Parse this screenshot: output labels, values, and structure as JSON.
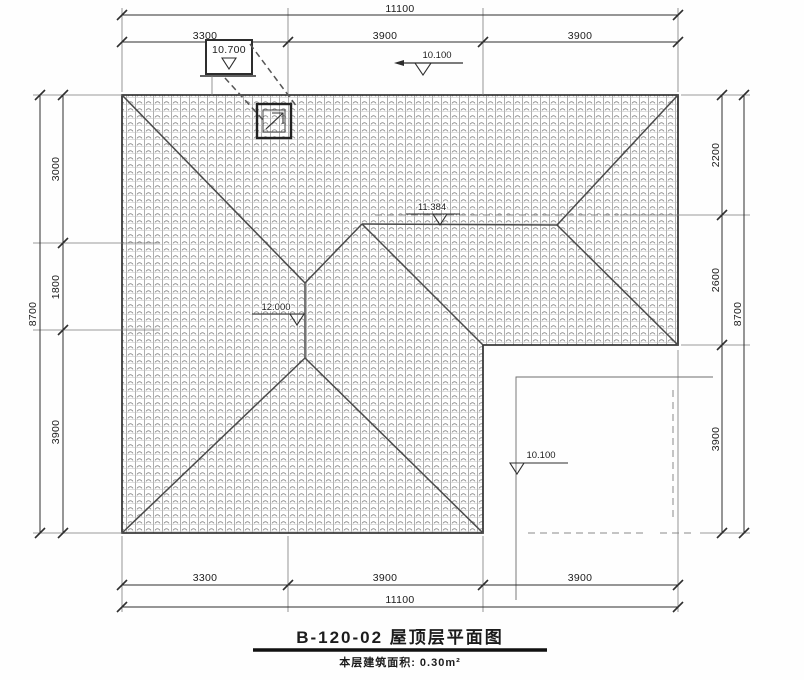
{
  "drawing": {
    "title": "B-120-02 屋顶层平面图",
    "area_note": "本层建筑面积: 0.30m²"
  },
  "dimensions": {
    "top": {
      "overall": "11100",
      "segments": [
        "3300",
        "3900",
        "3900"
      ]
    },
    "bottom": {
      "overall": "11100",
      "segments": [
        "3300",
        "3900",
        "3900"
      ]
    },
    "left": {
      "overall": "8700",
      "segments": [
        "3000",
        "1800",
        "3900"
      ]
    },
    "right": {
      "overall": "8700",
      "segments": [
        "2200",
        "2600",
        "3900"
      ]
    }
  },
  "levels": {
    "roof_access_box": "10.700",
    "eave_top": "10.100",
    "ridge_main": "12.000",
    "ridge_wing": "11.384",
    "terrace": "10.100"
  },
  "symbols": {
    "level_marker": "open down-triangle",
    "roof_access_hatch": "double square with flag"
  }
}
